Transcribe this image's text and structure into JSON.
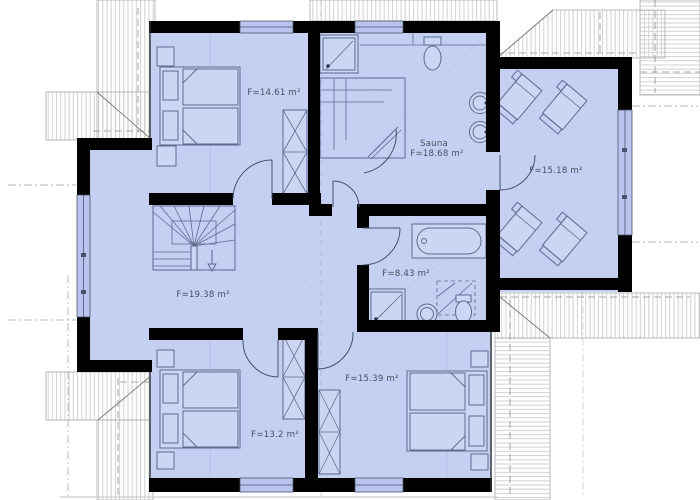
{
  "plan": {
    "title": "upper-floor-plan",
    "rooms": [
      {
        "name": "bedroom-top-left",
        "area_label": "F=14.61 m²"
      },
      {
        "name": "sauna",
        "room_name": "Sauna",
        "area_label": "F=18.68 m²"
      },
      {
        "name": "relax-room",
        "area_label": "F=15.18 m²"
      },
      {
        "name": "hall-stairs",
        "area_label": "F=19.38 m²"
      },
      {
        "name": "bathroom",
        "area_label": "F=8.43 m²"
      },
      {
        "name": "bedroom-bottom-left",
        "area_label": "F=13.2 m²"
      },
      {
        "name": "bedroom-bottom-right",
        "area_label": "F=15.39 m²"
      }
    ],
    "colors": {
      "floor": "#c5cff2",
      "wall": "#000000",
      "window": "#b9c5ee",
      "furniture_outline": "#5d6b8f",
      "roof_hatch": "#cccccc",
      "label_text": "#4a5060"
    }
  }
}
